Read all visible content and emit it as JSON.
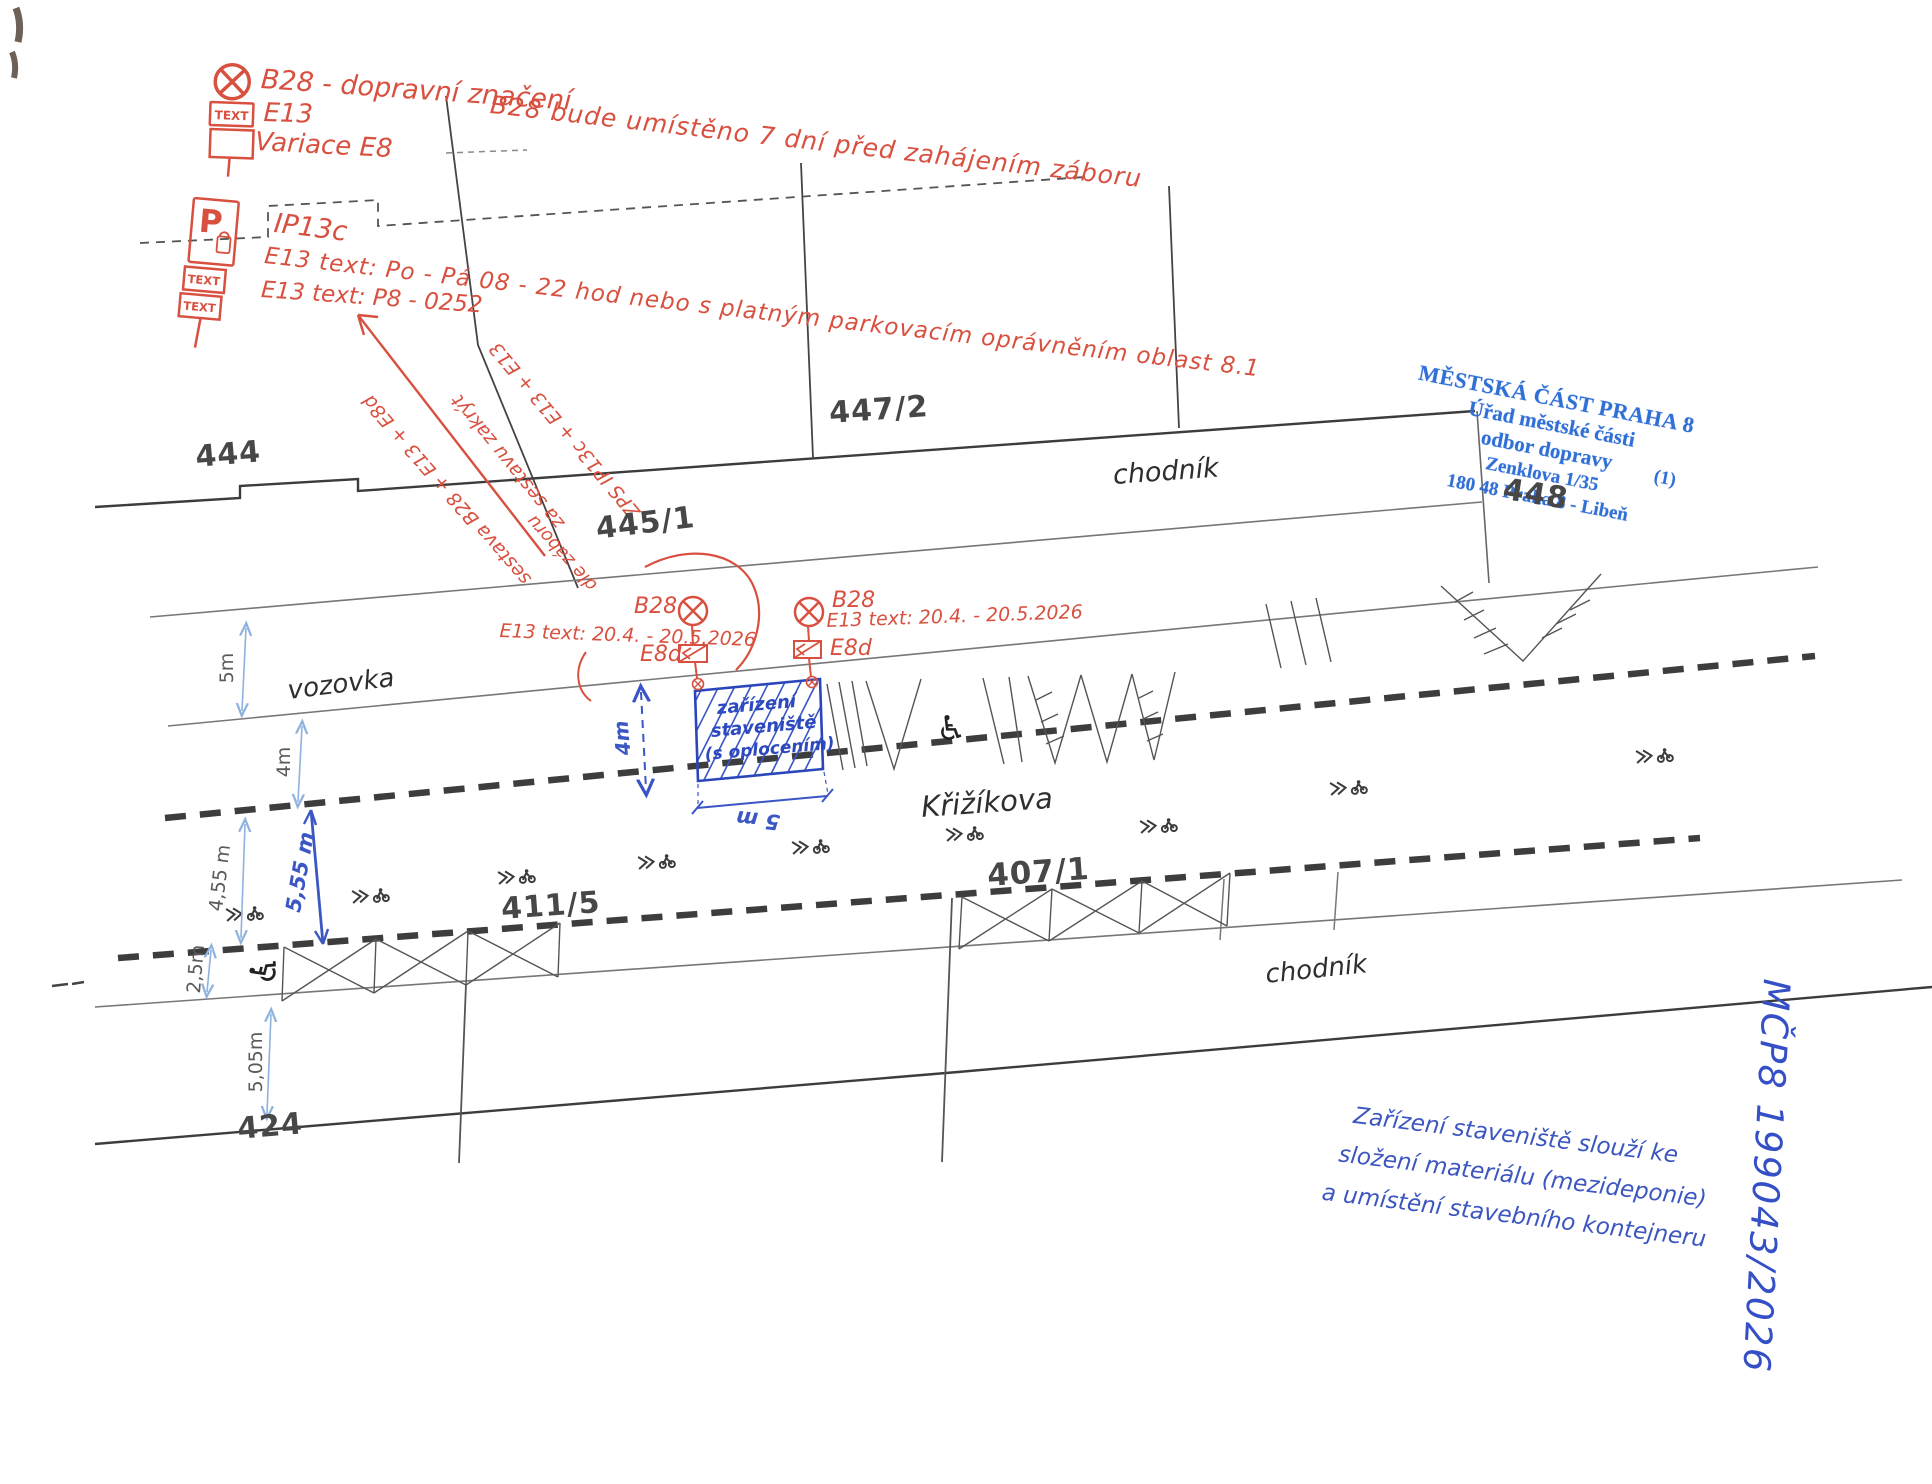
{
  "colors": {
    "red_ink": "#d8503f",
    "hand_blue": "#3c56c0",
    "stamp_blue": "#2f6fd6",
    "drawing_ink": "#3a3a3a",
    "dim_blue": "#8fb2de"
  },
  "red_notes": {
    "b28_assembly": {
      "title": "B28 - dopravní značení",
      "note": "B28 bude umístěno 7 dní před zahájením záboru",
      "e13": "E13",
      "e8": "Variace E8",
      "plate_text": "TEXT"
    },
    "ip13c_assembly": {
      "title": "IP13c",
      "e13_line1": "E13 text:  Po - Pá  08 - 22 hod  nebo  s platným parkovacím oprávněním oblast 8.1",
      "e13_line2": "E13 text:  P8 - 0252",
      "letter": "P",
      "plate_text": "TEXT"
    },
    "diagonal_note": {
      "line1": "ZPS IP13c + E13 + E13",
      "line2": "za sestavu zakrýt",
      "line3": "sestava B28 + E13 + E8d",
      "line4": "dle záboru"
    },
    "sign1": {
      "name": "B28",
      "e13": "E13 text: 20.4. - 20.5.2026",
      "e8d": "E8d"
    },
    "sign2": {
      "name": "B28",
      "e13": "E13 text: 20.4. - 20.5.2026",
      "e8d": "E8d"
    }
  },
  "construction_box": {
    "line1": "zařízení",
    "line2": "staveniště",
    "line3": "(s oplocením)",
    "width": "5 m",
    "height": "4m"
  },
  "dimensions": {
    "sidewalk_top": "5m",
    "parking_lane": "4m",
    "lane1": "4,55 m",
    "lane2": "5,55 m",
    "strip": "2,5m",
    "sidewalk_bottom": "5,05m"
  },
  "street_labels": {
    "sidewalk_top": "chodník",
    "roadway": "vozovka",
    "street_name": "Křižíkova",
    "sidewalk_bottom": "chodník"
  },
  "parcels": {
    "p444": "444",
    "p445_1": "445/1",
    "p447_2": "447/2",
    "p448": "448",
    "p424": "424",
    "p411_5": "411/5",
    "p407_1": "407/1"
  },
  "stamp": {
    "line1": "MĚSTSKÁ ČÁST PRAHA 8",
    "line2": "Úřad městské části",
    "line3": "odbor dopravy",
    "line4": "Zenklova 1/35",
    "line5": "180 48 Praha 8 - Libeň",
    "copy_number": "(1)"
  },
  "blue_note": {
    "line1": "Zařízení staveniště slouží ke",
    "line2": "složení materiálu (mezideponie)",
    "line3": "a umístění stavebního kontejneru"
  },
  "reference_number": "MČP8 199043/2026"
}
